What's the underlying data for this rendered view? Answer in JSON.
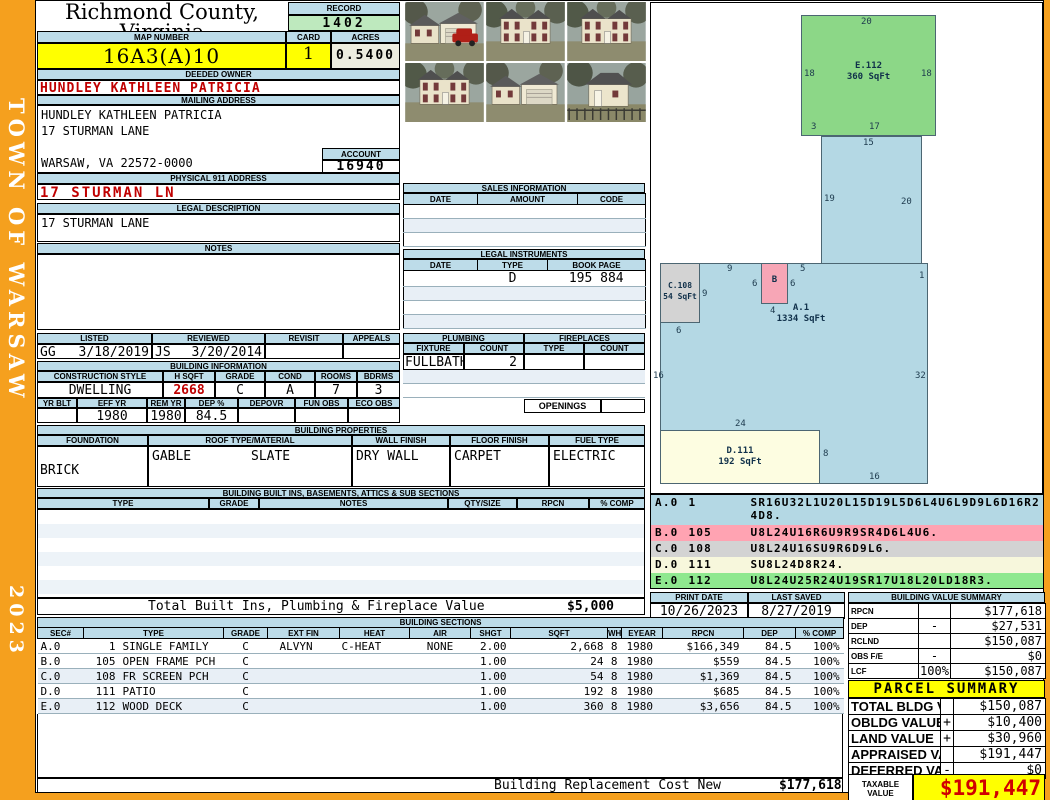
{
  "frame": {
    "town": "TOWN OF WARSAW",
    "year": "2023"
  },
  "header": {
    "county": "Richmond County, Virginia",
    "commissioner": "Commissioner of the Revenue, PO Box 366, Warsaw, VA 22572",
    "record_label": "RECORD",
    "record_value": "1402",
    "map_number_label": "MAP NUMBER",
    "map_number": "16A3(A)10",
    "card_label": "CARD",
    "card": "1",
    "acres_label": "ACRES",
    "acres": "0.5400"
  },
  "owner": {
    "deeded_owner_label": "DEEDED OWNER",
    "deeded_owner": "HUNDLEY KATHLEEN PATRICIA",
    "mailing_address_label": "MAILING ADDRESS",
    "mailing_line1": "HUNDLEY KATHLEEN PATRICIA",
    "mailing_line2": "17 STURMAN LANE",
    "mailing_line3": "",
    "mailing_line4": "WARSAW, VA 22572-0000",
    "account_label": "ACCOUNT",
    "account": "16940",
    "physical_address_label": "PHYSICAL 911 ADDRESS",
    "physical_address": "17 STURMAN LN",
    "legal_description_label": "LEGAL DESCRIPTION",
    "legal_description": "17 STURMAN LANE",
    "notes_label": "NOTES"
  },
  "review": {
    "listed_label": "LISTED",
    "listed_by": "GG",
    "listed_date": "3/18/2019",
    "reviewed_label": "REVIEWED",
    "reviewed_by": "JS",
    "reviewed_date": "3/20/2014",
    "revisit_label": "REVISIT",
    "revisit": "",
    "appeals_label": "APPEALS",
    "appeals": ""
  },
  "building_information": {
    "title": "BUILDING INFORMATION",
    "construction_style_label": "CONSTRUCTION STYLE",
    "construction_style": "DWELLING",
    "hsqft_label": "H SQFT",
    "hsqft": "2668",
    "grade_label": "GRADE",
    "grade": "C",
    "cond_label": "COND",
    "cond": "A",
    "rooms_label": "ROOMS",
    "rooms": "7",
    "bdrms_label": "BDRMS",
    "bdrms": "3",
    "yrblt_label": "YR BLT",
    "yrblt": "",
    "effyr_label": "EFF YR",
    "effyr": "1980",
    "remyr_label": "REM YR",
    "remyr": "1980",
    "dep_label": "DEP %",
    "dep": "84.5",
    "depovr_label": "DEPOVR",
    "depovr": "",
    "funobs_label": "FUN OBS",
    "funobs": "",
    "ecoobs_label": "ECO OBS",
    "ecoobs": ""
  },
  "sales": {
    "title": "SALES INFORMATION",
    "date_label": "DATE",
    "amount_label": "AMOUNT",
    "code_label": "CODE",
    "rows": [
      {
        "date": "",
        "amount": "",
        "code": ""
      },
      {
        "date": "",
        "amount": "",
        "code": "",
        "_bg": "#E8EFF6"
      },
      {
        "date": "",
        "amount": "",
        "code": ""
      }
    ]
  },
  "legal_instruments": {
    "title": "LEGAL INSTRUMENTS",
    "date_label": "DATE",
    "type_label": "TYPE",
    "book_label": "BOOK PAGE",
    "rows": [
      {
        "date": "",
        "type": "D",
        "book": "195 884"
      },
      {
        "date": "",
        "type": "",
        "book": "",
        "_bg": "#E8EFF6"
      },
      {
        "date": "",
        "type": "",
        "book": ""
      },
      {
        "date": "",
        "type": "",
        "book": "",
        "_bg": "#E8EFF6"
      }
    ]
  },
  "plumbing": {
    "title": "PLUMBING",
    "fixture_label": "FIXTURE",
    "count_label": "COUNT",
    "fixture": "FULLBATH",
    "count": "2"
  },
  "fireplaces": {
    "title": "FIREPLACES",
    "type_label": "TYPE",
    "count_label": "COUNT",
    "openings_label": "OPENINGS"
  },
  "building_properties": {
    "title": "BUILDING PROPERTIES",
    "foundation_label": "FOUNDATION",
    "foundation": "BRICK",
    "roof_label": "ROOF TYPE/MATERIAL",
    "roof_type": "GABLE",
    "roof_material": "SLATE",
    "wall_label": "WALL FINISH",
    "wall": "DRY WALL",
    "floor_label": "FLOOR FINISH",
    "floor": "CARPET",
    "fuel_label": "FUEL TYPE",
    "fuel": "ELECTRIC"
  },
  "built_ins": {
    "title": "BUILDING BUILT INS, BASEMENTS, ATTICS & SUB SECTIONS",
    "type_label": "TYPE",
    "grade_label": "GRADE",
    "notes_label": "NOTES",
    "qty_label": "QTY/SIZE",
    "rpcn_label": "RPCN",
    "comp_label": "% COMP",
    "total_label": "Total Built Ins, Plumbing & Fireplace Value",
    "total_value": "$5,000"
  },
  "sketch": {
    "areas": {
      "e112": {
        "name": "E.112",
        "size": "360 SqFt"
      },
      "a1": {
        "name": "A.1",
        "size": "1334 SqFt"
      },
      "b": {
        "name": "B"
      },
      "c108": {
        "name": "C.108",
        "size": "54 SqFt"
      },
      "d111": {
        "name": "D.111",
        "size": "192 SqFt"
      }
    },
    "dims": {
      "e_top": "20",
      "e_left": "18",
      "e_right": "18",
      "e_bottom_left": "3",
      "e_bottom": "17",
      "stem_top": "15",
      "stem_left": "19",
      "stem_right": "20",
      "top_9": "9",
      "top_5": "5",
      "right_1": "1",
      "b_left": "6",
      "b_right": "6",
      "b_bottom": "4",
      "c_right": "9",
      "c_bottom": "6",
      "left_16": "16",
      "right_32": "32",
      "d_top": "24",
      "d_right": "8",
      "bottom_16": "16"
    }
  },
  "sketch_codes": {
    "rows": [
      {
        "sec": "A.0",
        "num": "1",
        "code": "SR16U32L1U20L15D19L5D6L4U6L9D9L6D16R24D8.",
        "_bg": "#B4D8E4"
      },
      {
        "sec": "B.0",
        "num": "105",
        "code": "U8L24U16R6U9R9SR4D6L4U6.",
        "_bg": "#FFA3B2"
      },
      {
        "sec": "C.0",
        "num": "108",
        "code": "U8L24U16SU9R6D9L6.",
        "_bg": "#D3D3D3"
      },
      {
        "sec": "D.0",
        "num": "111",
        "code": "SU8L24D8R24.",
        "_bg": "#F7F7DC"
      },
      {
        "sec": "E.0",
        "num": "112",
        "code": "U8L24U25R24U19SR17U18L20LD18R3.",
        "_bg": "#8FE88F"
      }
    ]
  },
  "print_info": {
    "print_date_label": "PRINT DATE",
    "print_date": "10/26/2023",
    "last_saved_label": "LAST SAVED",
    "last_saved": "8/27/2019"
  },
  "value_summary": {
    "title": "BUILDING VALUE SUMMARY",
    "rows": [
      {
        "label": "RPCN",
        "sign": "",
        "value": "$177,618"
      },
      {
        "label": "DEP",
        "sign": "-",
        "value": "$27,531"
      },
      {
        "label": "RCLND",
        "sign": "",
        "value": "$150,087"
      },
      {
        "label": "OBS F/E",
        "sign": "-",
        "value": "$0"
      },
      {
        "label": "LCF",
        "sign": "100%",
        "value": "$150,087"
      }
    ]
  },
  "building_sections": {
    "title": "BUILDING SECTIONS",
    "headers": [
      "SEC#",
      "TYPE",
      "GRADE",
      "EXT FIN",
      "HEAT",
      "AIR",
      "SHGT",
      "SQFT",
      "WHGT",
      "EYEAR",
      "RPCN",
      "DEP",
      "% COMP"
    ],
    "rows": [
      {
        "sec": "A.0",
        "num": "1",
        "type": "SINGLE FAMILY",
        "grade": "C",
        "extfin": "ALVYN",
        "heat": "C-HEAT",
        "air": "NONE",
        "shgt": "2.00",
        "sqft": "2,668",
        "whgt": "8",
        "eyear": "1980",
        "rpcn": "$166,349",
        "dep": "84.5",
        "comp": "100%"
      },
      {
        "sec": "B.0",
        "num": "105",
        "type": "OPEN FRAME PCH",
        "grade": "C",
        "extfin": "",
        "heat": "",
        "air": "",
        "shgt": "1.00",
        "sqft": "24",
        "whgt": "8",
        "eyear": "1980",
        "rpcn": "$559",
        "dep": "84.5",
        "comp": "100%"
      },
      {
        "sec": "C.0",
        "num": "108",
        "type": "FR SCREEN PCH",
        "grade": "C",
        "extfin": "",
        "heat": "",
        "air": "",
        "shgt": "1.00",
        "sqft": "54",
        "whgt": "8",
        "eyear": "1980",
        "rpcn": "$1,369",
        "dep": "84.5",
        "comp": "100%",
        "_bg": "#E8EFF6"
      },
      {
        "sec": "D.0",
        "num": "111",
        "type": "PATIO",
        "grade": "C",
        "extfin": "",
        "heat": "",
        "air": "",
        "shgt": "1.00",
        "sqft": "192",
        "whgt": "8",
        "eyear": "1980",
        "rpcn": "$685",
        "dep": "84.5",
        "comp": "100%"
      },
      {
        "sec": "E.0",
        "num": "112",
        "type": "WOOD DECK",
        "grade": "C",
        "extfin": "",
        "heat": "",
        "air": "",
        "shgt": "1.00",
        "sqft": "360",
        "whgt": "8",
        "eyear": "1980",
        "rpcn": "$3,656",
        "dep": "84.5",
        "comp": "100%",
        "_bg": "#E8EFF6"
      }
    ]
  },
  "parcel_summary": {
    "title": "PARCEL SUMMARY",
    "rows": [
      {
        "label": "TOTAL BLDG VALUE",
        "sign": "",
        "value": "$150,087"
      },
      {
        "label": "OBLDG VALUE",
        "sign": "+",
        "value": "$10,400"
      },
      {
        "label": "LAND VALUE",
        "sign": "+",
        "value": "$30,960"
      },
      {
        "label": "APPRAISED VALUE",
        "sign": "",
        "value": "$191,447"
      },
      {
        "label": "DEFERRED VALUE",
        "sign": "-",
        "value": "$0"
      }
    ],
    "taxable_label": "TAXABLE VALUE",
    "taxable_value": "$191,447"
  },
  "footer": {
    "replacement_label": "Building Replacement Cost New",
    "replacement_value": "$177,618"
  }
}
